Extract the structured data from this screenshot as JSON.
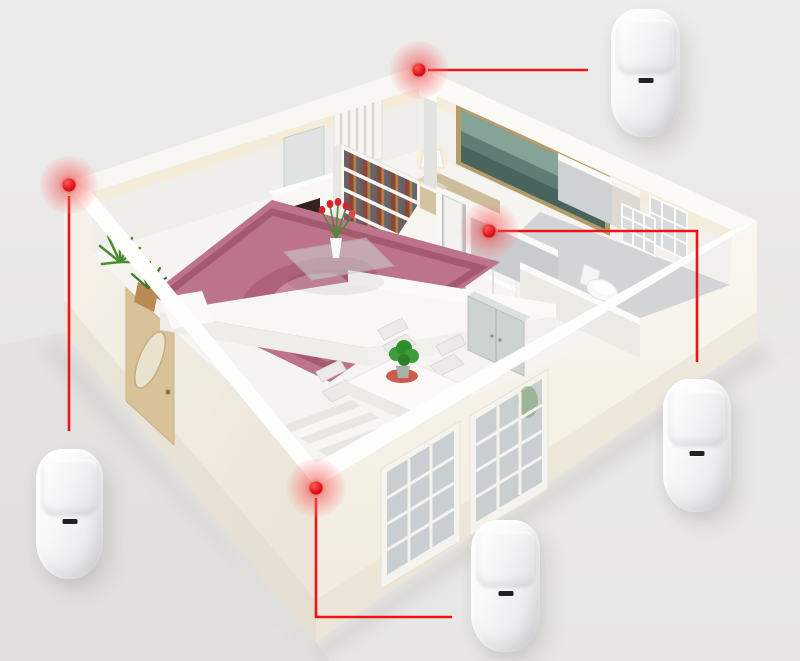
{
  "scene": {
    "aria_label": "3D cutaway floor plan of an apartment with four wireless PIR motion sensors connected by red callout lines to their wall-corner mounting points",
    "floorplan_parts": [
      "living-room",
      "bedroom",
      "bathroom",
      "hallway",
      "dining-area",
      "entry-door",
      "front-windows",
      "stairs"
    ]
  },
  "palette": {
    "accent_red": "#ee1416",
    "marker_red": "#e01117",
    "background_top": "#ececeb",
    "background_bottom": "#e3e2e0",
    "device_body": "#ececee",
    "device_slot": "#222226",
    "wall_white": "#fbfbf9",
    "wall_warm": "#f5f1e8",
    "rug_pink": "#bd7389",
    "plant_green": "#4c8a34",
    "fire_orange": "#ff8c2a",
    "door_tan": "#d8c29a",
    "painting_teal": "#5f7d74"
  },
  "devices": [
    {
      "id": "pir-sensor-top-right",
      "type": "pir-motion-sensor",
      "x": 611,
      "y": 9,
      "w": 69,
      "h": 128
    },
    {
      "id": "pir-sensor-left",
      "type": "pir-motion-sensor",
      "x": 36,
      "y": 449,
      "w": 67,
      "h": 130
    },
    {
      "id": "pir-sensor-right",
      "type": "pir-motion-sensor",
      "x": 663,
      "y": 379,
      "w": 68,
      "h": 133
    },
    {
      "id": "pir-sensor-bottom",
      "type": "pir-motion-sensor",
      "x": 471,
      "y": 520,
      "w": 69,
      "h": 132
    }
  ],
  "markers": [
    {
      "id": "marker-back-corner",
      "x": 419,
      "y": 70
    },
    {
      "id": "marker-left-corner",
      "x": 69,
      "y": 185
    },
    {
      "id": "marker-hallway-wall",
      "x": 489,
      "y": 231
    },
    {
      "id": "marker-front-corner",
      "x": 316,
      "y": 488
    }
  ],
  "callout_lines": [
    {
      "id": "callout-line-top",
      "points": [
        [
          428,
          70
        ],
        [
          588,
          70
        ]
      ]
    },
    {
      "id": "callout-line-left",
      "points": [
        [
          69,
          196
        ],
        [
          69,
          431
        ]
      ]
    },
    {
      "id": "callout-line-right",
      "points": [
        [
          498,
          231
        ],
        [
          697,
          231
        ],
        [
          697,
          362
        ]
      ]
    },
    {
      "id": "callout-line-bottom",
      "points": [
        [
          316,
          498
        ],
        [
          316,
          617
        ],
        [
          452,
          617
        ]
      ]
    }
  ]
}
